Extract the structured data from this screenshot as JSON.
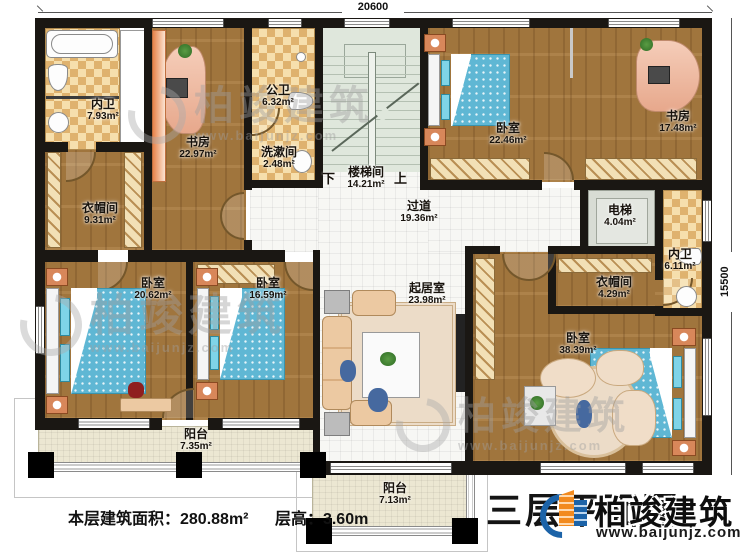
{
  "dimensions": {
    "top": "20600",
    "right": "15500"
  },
  "rooms": {
    "bath_tl": {
      "name": "内卫",
      "area": "7.93m²"
    },
    "study_tl": {
      "name": "书房",
      "area": "22.97m²"
    },
    "public_bath": {
      "name": "公卫",
      "area": "6.32m²"
    },
    "wash_room": {
      "name": "洗漱间",
      "area": "2.48m²"
    },
    "stairwell": {
      "name": "楼梯间",
      "area": "14.21m²",
      "down": "下",
      "up": "上"
    },
    "bedroom_tr": {
      "name": "卧室",
      "area": "22.46m²"
    },
    "study_tr": {
      "name": "书房",
      "area": "17.48m²"
    },
    "closet_left": {
      "name": "衣帽间",
      "area": "9.31m²"
    },
    "hallway": {
      "name": "过道",
      "area": "19.36m²"
    },
    "elevator": {
      "name": "电梯",
      "area": "4.04m²"
    },
    "bath_right": {
      "name": "内卫",
      "area": "6.11m²"
    },
    "closet_right": {
      "name": "衣帽间",
      "area": "4.29m²"
    },
    "bedroom_bl": {
      "name": "卧室",
      "area": "20.62m²"
    },
    "bedroom_bm": {
      "name": "卧室",
      "area": "16.59m²"
    },
    "living": {
      "name": "起居室",
      "area": "23.98m²"
    },
    "bedroom_master": {
      "name": "卧室",
      "area": "38.39m²"
    },
    "balcony_left": {
      "name": "阳台",
      "area": "7.35m²"
    },
    "balcony_center": {
      "name": "阳台",
      "area": "7.13m²"
    }
  },
  "footer": {
    "floor_area_label": "本层建筑面积：280.88m²",
    "height_label": "层高：3.60m"
  },
  "title_block": {
    "title": "三层平面图",
    "brand": "柏竣建筑",
    "website": "www.baijunjz.com"
  },
  "watermark": {
    "brand": "柏竣建筑",
    "website": "www.baijunjz.com"
  },
  "colors": {
    "wall": "#1a1713",
    "wood": "#a97b40",
    "tile_light": "#f6dfad",
    "tile_dark": "#dfb26e",
    "stair": "#dfe7dc",
    "bed": "#5fb7d4",
    "balcony": "#ece7d2",
    "logo_blue": "#1c63a8",
    "logo_orange": "#f28a1e"
  }
}
